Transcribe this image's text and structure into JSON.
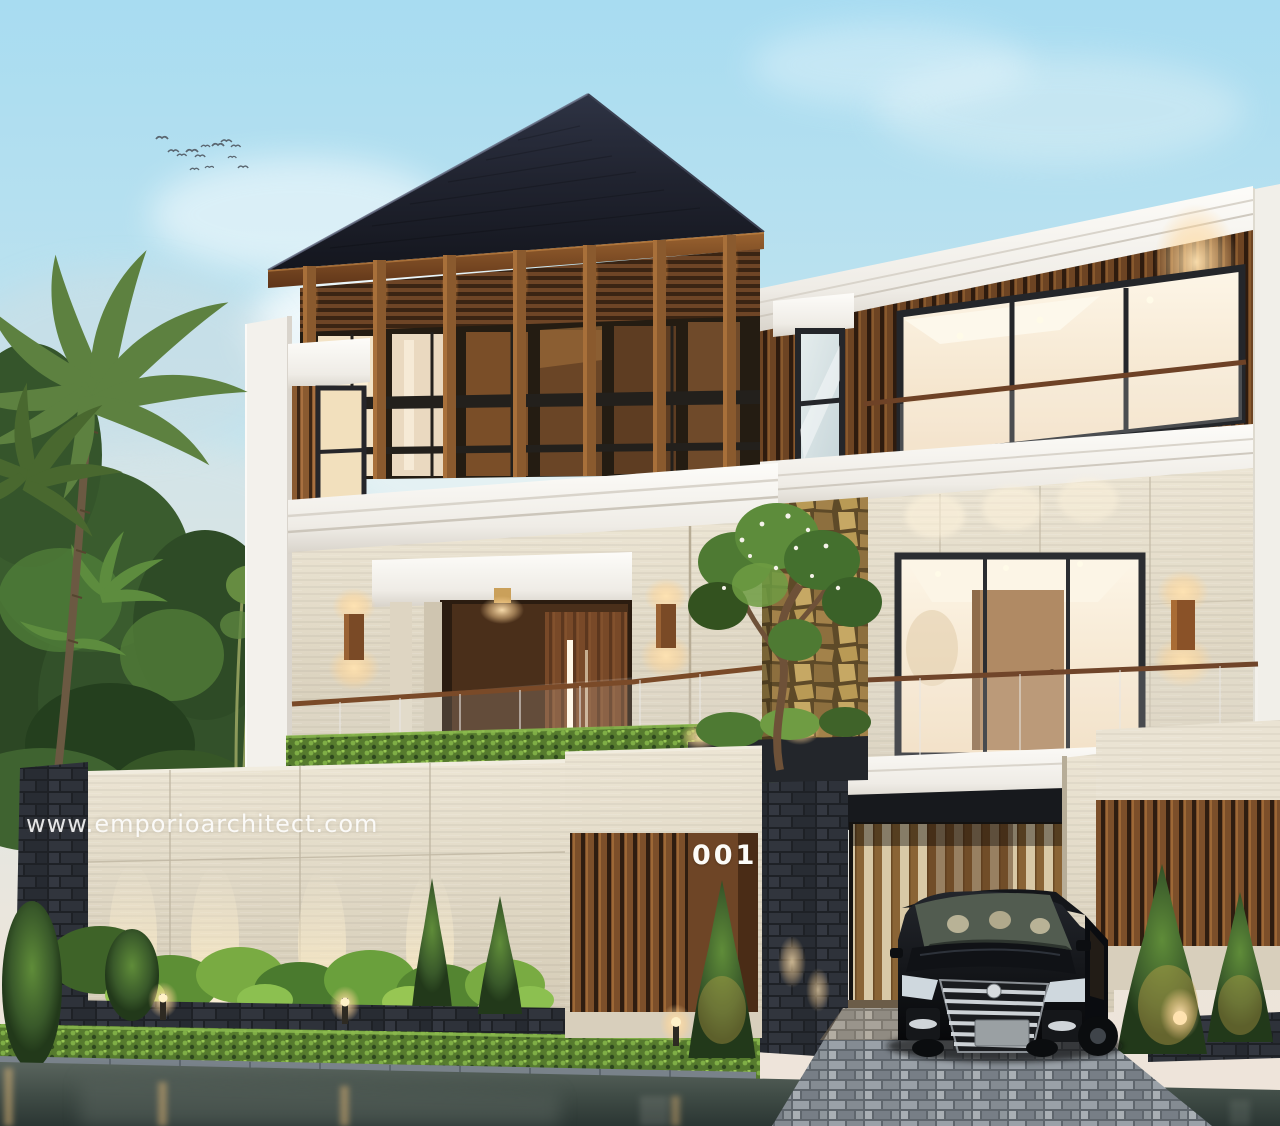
{
  "scene": {
    "type": "architectural exterior render",
    "subject": "modern tropical two-storey house with basement garage at dusk",
    "watermark": {
      "text": "www.emporioarchitect.com"
    },
    "house": {
      "number": "001"
    },
    "objects": [
      "dark hip roof",
      "timber post clerestory",
      "wooden slat facade",
      "white concrete cornices",
      "cream travertine walls",
      "glass balcony railings",
      "recessed entry door with LED strip",
      "wall sconces",
      "stone fence with uplights",
      "garden planter with hedge",
      "frangipani tree",
      "palm trees",
      "bird flock",
      "black minivan in carport",
      "paver driveway",
      "wet road with light reflections"
    ],
    "palette": {
      "sky_top": "#aadcf0",
      "sky_horizon": "#efe7de",
      "roof": "#1f2230",
      "wood": "#8a5a30",
      "wood_lit": "#c98a46",
      "trim_white": "#f6f4f0",
      "stone_cream": "#e2dac8",
      "stone_dark": "#2b2e34",
      "accent_rock_gold": "#b3914f",
      "foliage_dark": "#2c4724",
      "hedge_green": "#6fa03c",
      "warm_light": "#ffc985",
      "glass_warm": "#f7e9d2",
      "road": "#46514c",
      "car_black": "#111318"
    }
  }
}
